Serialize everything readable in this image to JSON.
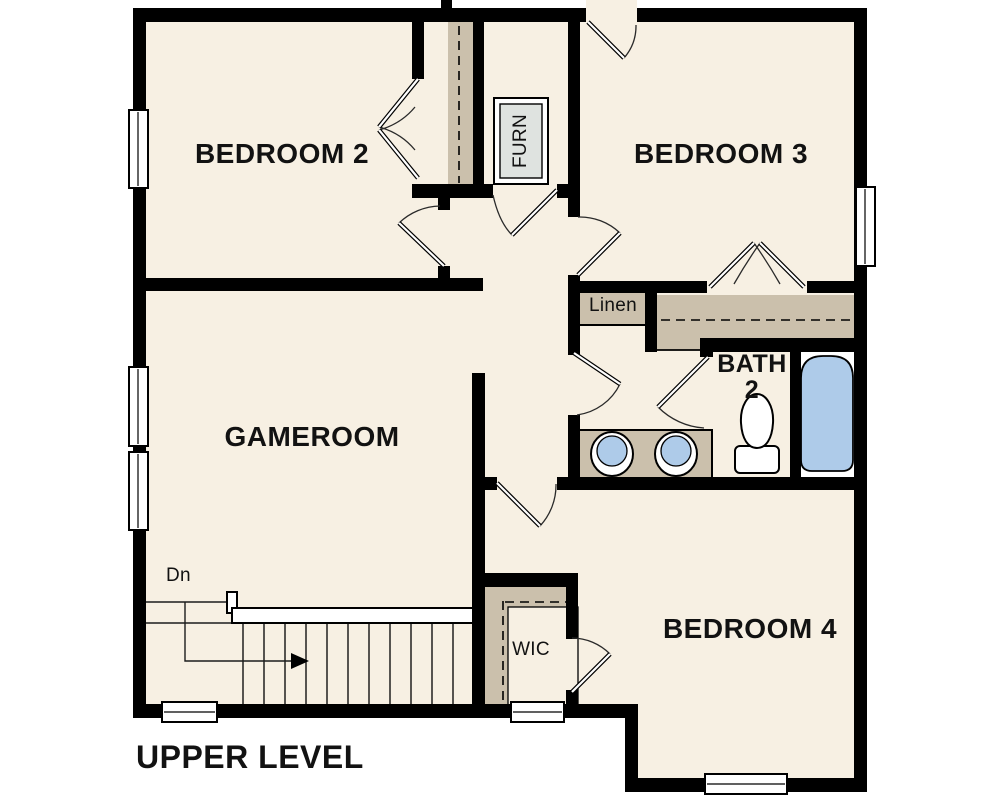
{
  "title": "UPPER LEVEL",
  "labels": {
    "bedroom2": "BEDROOM 2",
    "bedroom3": "BEDROOM 3",
    "gameroom": "GAMEROOM",
    "bedroom4": "BEDROOM 4",
    "bath_line1": "BATH",
    "bath_line2": "2",
    "linen": "Linen",
    "wic": "WIC",
    "furnace": "FURN",
    "stairs_down": "Dn"
  },
  "colors": {
    "floor": "#F7F0E3",
    "wall": "#000000",
    "shelf": "#CBC0AC",
    "fixture_blue": "#AECBE9",
    "furnace_gray": "#DFE3E0",
    "label": "#121212",
    "background": "#FFFFFF"
  }
}
